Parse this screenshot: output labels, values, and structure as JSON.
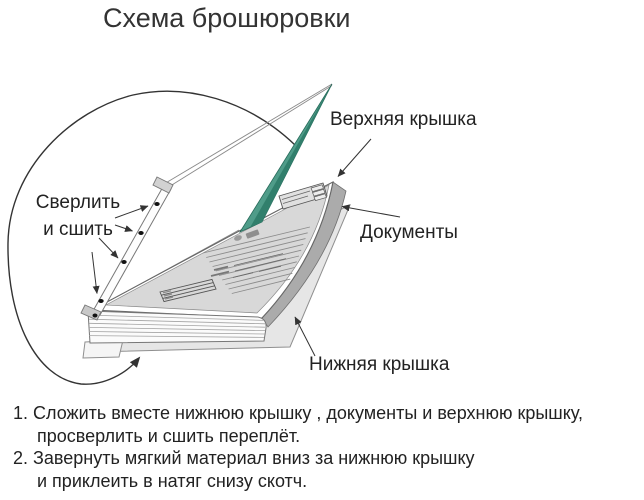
{
  "title": "Схема брошюровки",
  "diagram": {
    "labels": {
      "drill_line1": "Сверлить",
      "drill_line2": "и сшить",
      "top_cover": "Верхняя крышка",
      "documents": "Документы",
      "bottom_cover": "Нижняя крышка"
    },
    "colors": {
      "top_cover_teal": "#4f9c89",
      "top_cover_teal_dark": "#317f6c",
      "document_gray": "#d8d8d8",
      "stack_side_gray": "#ababab",
      "bottom_cover_gray": "#e6e6e6",
      "pages_white": "#fbfbfb",
      "outline": "#555555",
      "arrow": "#333333"
    },
    "drill_holes_count": 4
  },
  "instructions": {
    "lines": [
      "1. Сложить вместе нижнюю крышку , документы и верхнюю крышку,",
      "просверлить и сшить переплёт.",
      "2. Завернуть мягкий материал вниз за нижнюю крышку",
      "и приклеить в натяг снизу скотч."
    ]
  }
}
